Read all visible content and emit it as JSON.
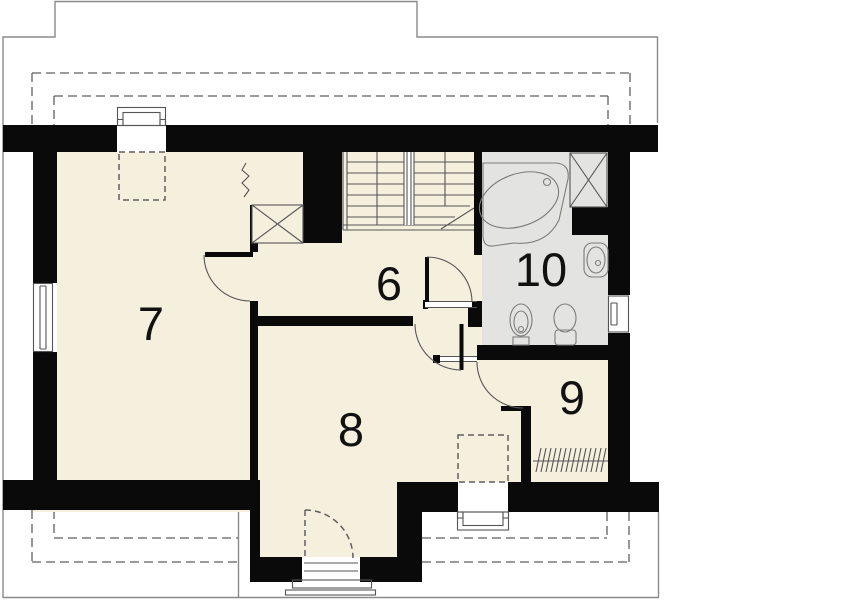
{
  "page_title": "Attic floor plan",
  "rooms": [
    {
      "id": "room-6",
      "label": "6"
    },
    {
      "id": "room-7",
      "label": "7"
    },
    {
      "id": "room-8",
      "label": "8"
    },
    {
      "id": "room-9",
      "label": "9"
    },
    {
      "id": "room-10",
      "label": "10"
    }
  ],
  "colors": {
    "wall": "#0a0a0a",
    "floor_cream": "#f5f0dd",
    "bathroom_gray": "#e3e3e1",
    "background": "#ffffff",
    "outline_gray": "#8a8a8a",
    "dash_gray": "#5f5f5f",
    "line_gray": "#555555",
    "fixture_fill": "#ececea",
    "fixture_stroke": "#7c7c7a",
    "label_color": "#111111"
  }
}
